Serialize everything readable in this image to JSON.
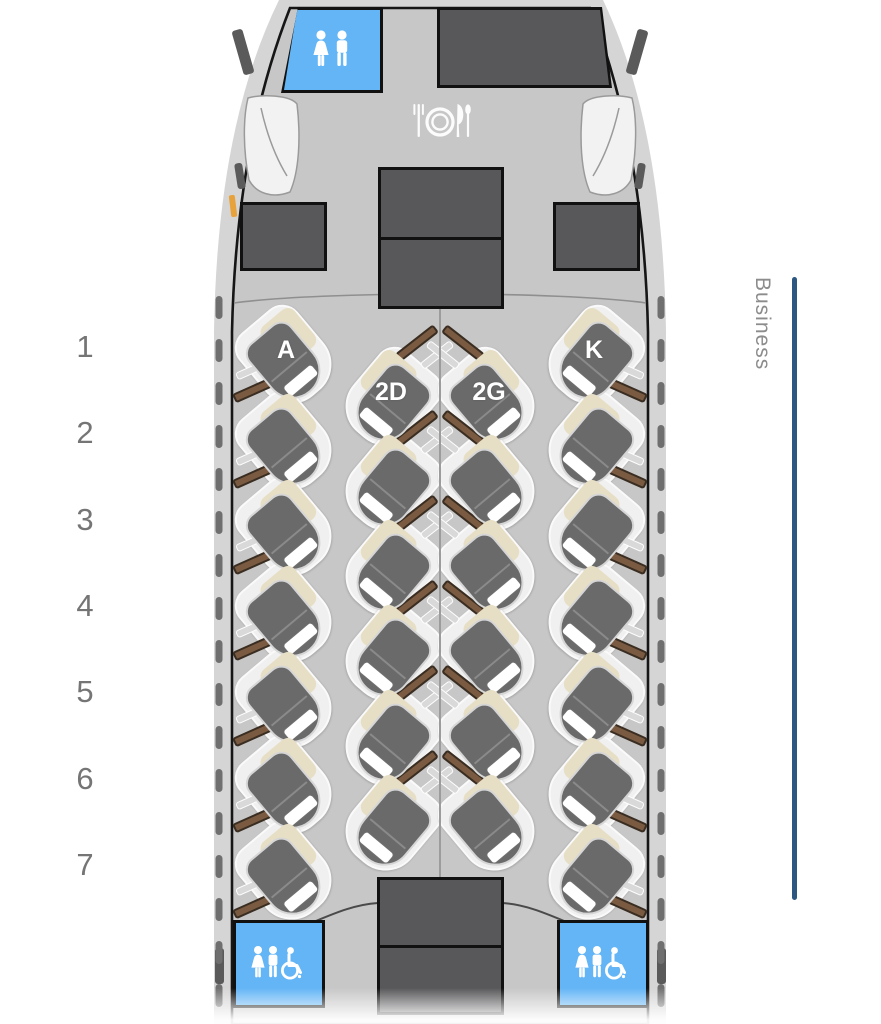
{
  "cabin": {
    "section_label": "Business",
    "row_numbers": [
      "1",
      "2",
      "3",
      "4",
      "5",
      "6",
      "7"
    ],
    "seat_columns": [
      "A",
      "D",
      "G",
      "K"
    ],
    "seats": [
      {
        "id": "1A",
        "row": 1,
        "col": "A",
        "label": "A"
      },
      {
        "id": "1K",
        "row": 1,
        "col": "K",
        "label": "K"
      },
      {
        "id": "2A",
        "row": 2,
        "col": "A",
        "label": ""
      },
      {
        "id": "2D",
        "row": 2,
        "col": "D",
        "label": "2D"
      },
      {
        "id": "2G",
        "row": 2,
        "col": "G",
        "label": "2G"
      },
      {
        "id": "2K",
        "row": 2,
        "col": "K",
        "label": ""
      },
      {
        "id": "3A",
        "row": 3,
        "col": "A",
        "label": ""
      },
      {
        "id": "3D",
        "row": 3,
        "col": "D",
        "label": ""
      },
      {
        "id": "3G",
        "row": 3,
        "col": "G",
        "label": ""
      },
      {
        "id": "3K",
        "row": 3,
        "col": "K",
        "label": ""
      },
      {
        "id": "4A",
        "row": 4,
        "col": "A",
        "label": ""
      },
      {
        "id": "4D",
        "row": 4,
        "col": "D",
        "label": ""
      },
      {
        "id": "4G",
        "row": 4,
        "col": "G",
        "label": ""
      },
      {
        "id": "4K",
        "row": 4,
        "col": "K",
        "label": ""
      },
      {
        "id": "5A",
        "row": 5,
        "col": "A",
        "label": ""
      },
      {
        "id": "5D",
        "row": 5,
        "col": "D",
        "label": ""
      },
      {
        "id": "5G",
        "row": 5,
        "col": "G",
        "label": ""
      },
      {
        "id": "5K",
        "row": 5,
        "col": "K",
        "label": ""
      },
      {
        "id": "6A",
        "row": 6,
        "col": "A",
        "label": ""
      },
      {
        "id": "6D",
        "row": 6,
        "col": "D",
        "label": ""
      },
      {
        "id": "6G",
        "row": 6,
        "col": "G",
        "label": ""
      },
      {
        "id": "6K",
        "row": 6,
        "col": "K",
        "label": ""
      },
      {
        "id": "7A",
        "row": 7,
        "col": "A",
        "label": ""
      },
      {
        "id": "7D",
        "row": 7,
        "col": "D",
        "label": ""
      },
      {
        "id": "7G",
        "row": 7,
        "col": "G",
        "label": ""
      },
      {
        "id": "7K",
        "row": 7,
        "col": "K",
        "label": ""
      }
    ],
    "amenities": {
      "front_lavatory_icons": [
        "woman-icon",
        "man-icon"
      ],
      "rear_left_lavatory_icons": [
        "woman-icon",
        "man-icon",
        "wheelchair-icon"
      ],
      "rear_right_lavatory_icons": [
        "woman-icon",
        "man-icon",
        "wheelchair-icon"
      ],
      "dining_icon": "restaurant-icon",
      "galleys": [
        "front-right-galley",
        "front-center-monument",
        "left-closet",
        "right-closet",
        "rear-center-galley"
      ]
    },
    "colors": {
      "fuselage": "#d5d5d5",
      "cabin_floor": "#c7c7c7",
      "monument": "#58585a",
      "lavatory_blue": "#64b5f6",
      "seat": "#6a6a6a",
      "seat_shell": "#f0f0f0",
      "pillow": "#e7dfc5",
      "console_brown": "#7a5b42",
      "window": "#6f6f6f",
      "business_line": "#2b5781",
      "row_number_gray": "#757575",
      "exit_orange": "#e8a23c"
    }
  }
}
